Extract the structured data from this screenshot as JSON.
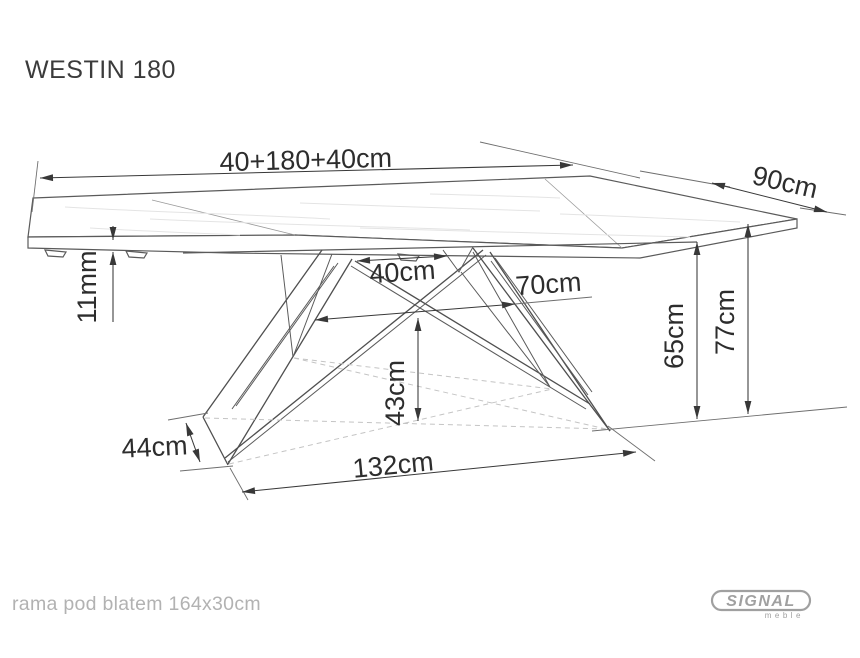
{
  "title": "WESTIN 180",
  "dimensions": {
    "total_length": "40+180+40cm",
    "depth": "90cm",
    "top_thickness": "11mm",
    "leg_mount_gap": "40cm",
    "leg_mid_span": "70cm",
    "cross_height": "43cm",
    "underframe_height": "65cm",
    "total_height": "77cm",
    "foot_length": "44cm",
    "feet_span": "132cm"
  },
  "footer": {
    "note": "rama pod blatem 164x30cm"
  },
  "logo": {
    "brand": "SIGNAL",
    "sub": "meble"
  },
  "colors": {
    "line": "#5a5a5a",
    "dimension": "#383838",
    "text": "#2d2d2d",
    "muted_text": "#b2b2b2",
    "logo_gray": "#a0a0a0",
    "background": "#ffffff"
  }
}
